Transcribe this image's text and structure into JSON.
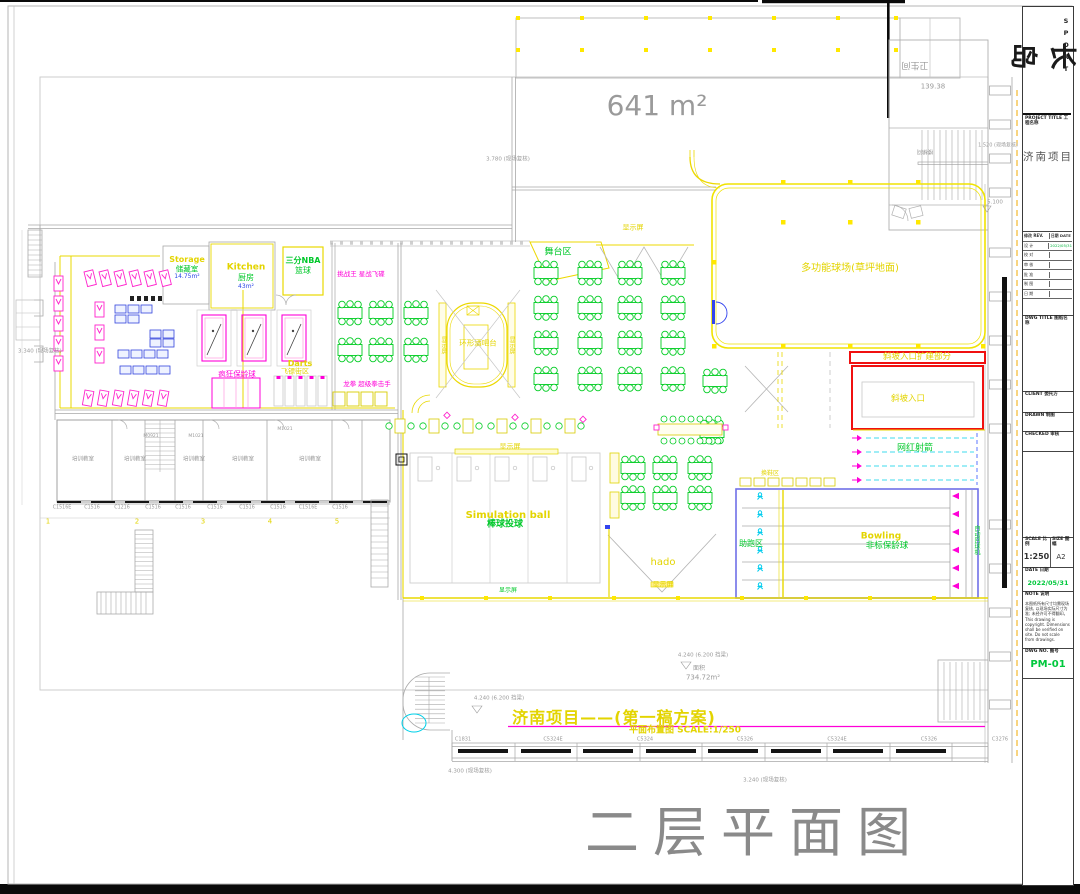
{
  "sheet": {
    "floor_title": "二层平面图",
    "banner_title": "济南项目——(第一稿方案)",
    "banner_sub": "平面布置图  SCALE:1/250",
    "area_main": "641 m²"
  },
  "plan": {
    "court": "多功能球场(草坪地面)",
    "ramp_ext": "斜坡入口扩建部分",
    "ramp": "斜坡入口",
    "archery": "网红射箭",
    "bowling_en": "Bowling",
    "bowling_cn": "非标保龄球",
    "runup": "助跑区",
    "ball_return": "自动回球机",
    "shoe_change": "换鞋区",
    "sim_en": "Simulation ball",
    "sim_cn": "棒球投球",
    "hado": "hado",
    "screen": "显示屏",
    "stage": "舞台区",
    "bar": "环形酒吧台",
    "storage_en": "Storage",
    "storage_cn": "储藏室",
    "storage_area": "14.75m²",
    "kitchen_en": "Kitchen",
    "kitchen_cn": "厨房",
    "kitchen_area": "43m²",
    "nba_1": "三分NBA",
    "nba_2": "篮球",
    "darts_en": "Darts",
    "darts_cn": "飞镖街区",
    "crazy_bowling": "疯狂保龄球",
    "boxing": "龙拳 超级拳击手",
    "arcade": "挑战王 星战飞碟",
    "room": "培训教室",
    "wc": "卫生间",
    "stair": "楼梯间",
    "dims": {
      "d139": "139.38",
      "d5100": "5.100",
      "d3780": "3.780 (现场复核)",
      "d1520": "1.520 (现场复核)",
      "d3340": "3.340 (现场复核)",
      "da": "4.240 (6.200 挡梁)",
      "dc": "4.300 (现场复核)",
      "dd": "3.240 (现场复核)",
      "area_label": "面积",
      "area": "734.72m²"
    },
    "grid_nums": [
      "1",
      "2",
      "3",
      "4",
      "5"
    ],
    "room_windows": [
      "C1516E",
      "C1516",
      "C1216",
      "C1516",
      "C1516",
      "C1516",
      "C1516",
      "C1516",
      "C1516E",
      "C1516"
    ],
    "south_windows": [
      "C1831",
      "C5324E",
      "C5324",
      "C5326",
      "C5324E",
      "C5326",
      "C3276"
    ],
    "door_codes": [
      "M0921",
      "M1021",
      "M1021"
    ]
  },
  "titleblock": {
    "logo_cn": "长岛",
    "logo_en": "SPORT",
    "project_label": "PROJECT TITLE 工程名称",
    "project_name": "济南项目",
    "rev_header": {
      "left": "修改 REV.",
      "right": "日期 DATE"
    },
    "rev_rows": [
      {
        "label": "设 计",
        "value": "2022/05/31"
      },
      {
        "label": "校 对",
        "value": ""
      },
      {
        "label": "审 核",
        "value": ""
      },
      {
        "label": "批 准",
        "value": ""
      },
      {
        "label": "制 图",
        "value": ""
      },
      {
        "label": "日 期",
        "value": ""
      }
    ],
    "section_dwg_title": "DWG TITLE 图纸名称",
    "section_client": "CLIENT 委托方",
    "section_drawn": "DRAWN 制图",
    "section_checked": "CHECKED 审核",
    "scale_label": "SCALE 比例",
    "scale_value": "1:250",
    "size_label": "SIZE 图幅",
    "size_value": "A2",
    "date_label": "DATE 日期",
    "date_value": "2022/05/31",
    "note_label": "NOTE 说明",
    "notes": "本图纸所有尺寸均需现场复核, 以现场实际尺寸为准; 未经许可不得翻印。 This drawing is copyright. Dimensions shall be verified on site. Do not scale from drawings.",
    "dwgno_label": "DWG NO. 图号",
    "dwgno_value": "PM-01"
  },
  "colors": {
    "cad_yellow": "#e9d900",
    "cad_green": "#00cc22",
    "cad_magenta": "#ff00d8",
    "cad_cyan": "#00d2ea",
    "highlight_red": "#f01010",
    "lane_blue": "#7070e8",
    "annotation_gray": "#9a9a9a",
    "accent_green_text": "#00c83c"
  }
}
